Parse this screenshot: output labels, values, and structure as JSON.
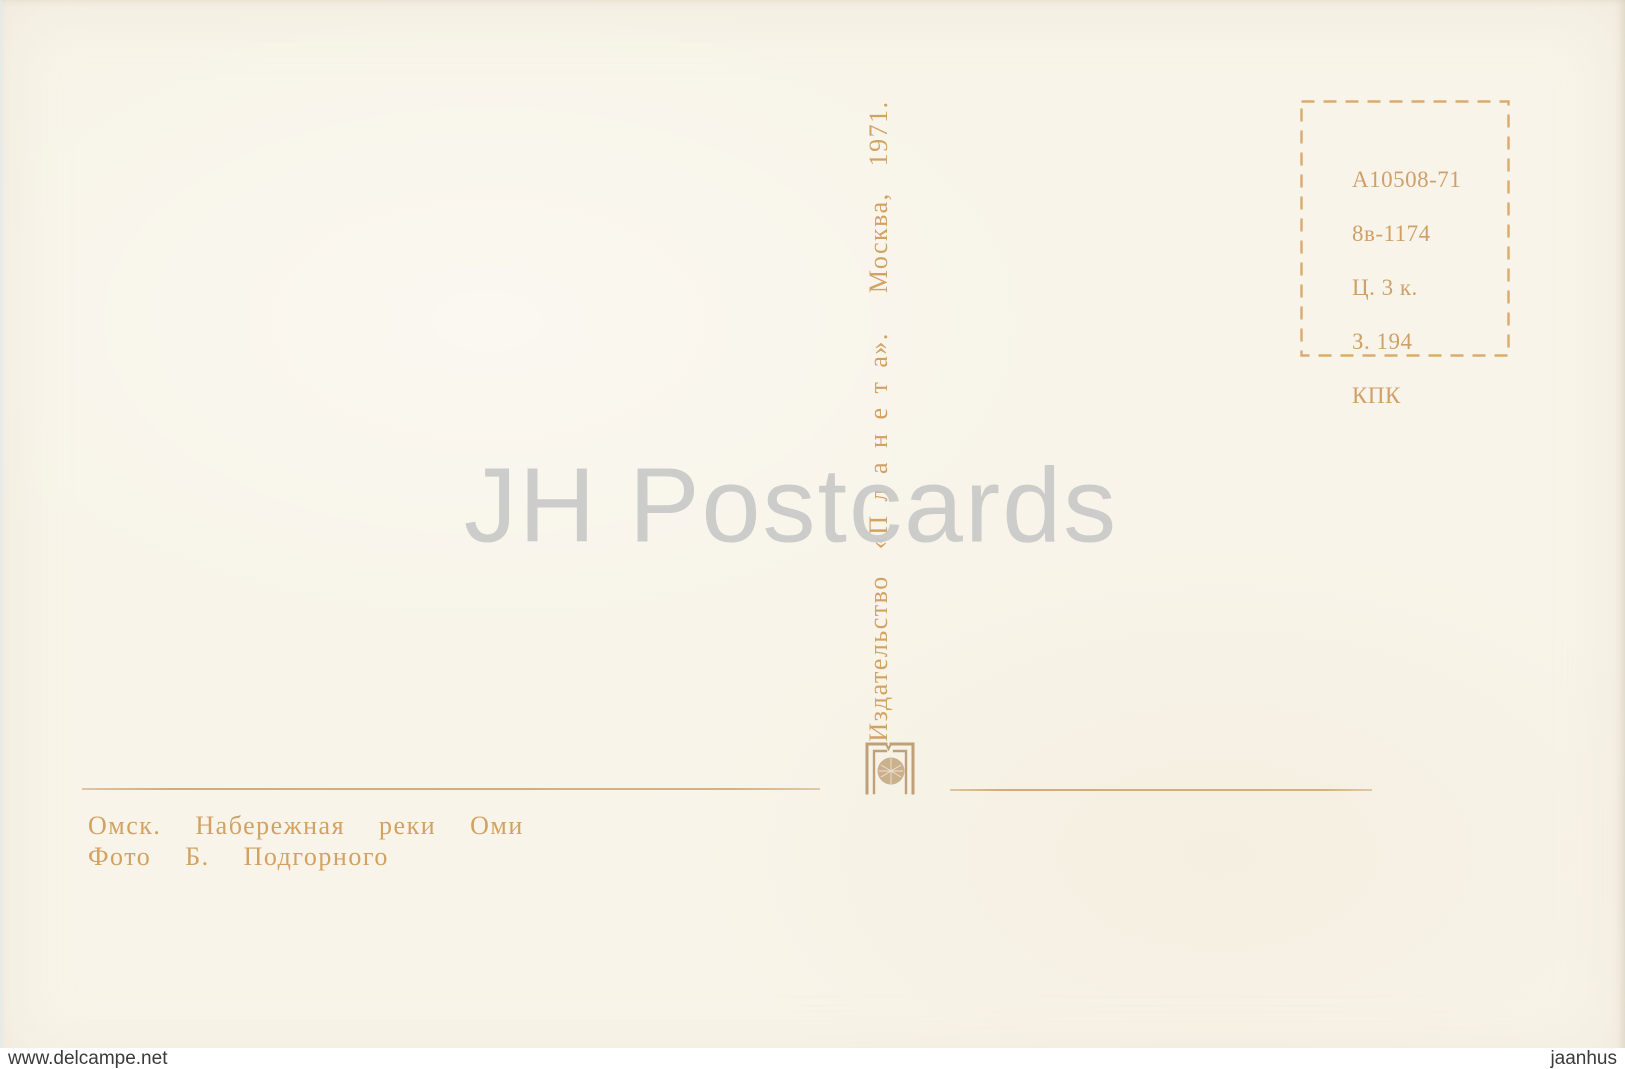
{
  "postcard": {
    "stamp_box": {
      "lines": [
        "А10508-71",
        "8в-1174",
        "Ц. 3 к.",
        "З. 194",
        "КПК"
      ]
    },
    "publisher_imprint": "Издательство  «П л а н е т а».   Москва,  1971.",
    "caption": {
      "title": "Омск.  Набережная  реки  Оми",
      "photo_credit": "Фото  Б.  Подгорного"
    },
    "icons": {
      "planeta_logo": "planeta-publisher-emblem"
    },
    "colors": {
      "card_background": "#f8f4e9",
      "print_tan": "#d2a263",
      "stamp_border_tan": "#d9ab6e",
      "watermark_gray": "#c9c9c9",
      "footer_text": "#3a3a3a"
    }
  },
  "watermark": {
    "text": "JH Postcards"
  },
  "footer": {
    "left_url": "www.delcampe.net",
    "right_name": "jaanhus"
  }
}
